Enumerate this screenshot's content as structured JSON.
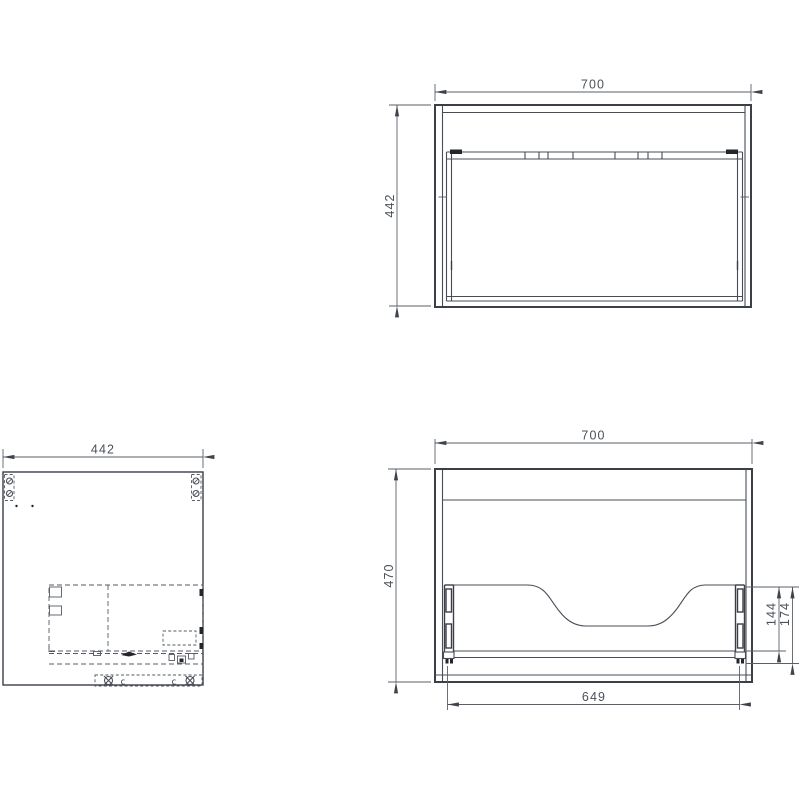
{
  "drawing": {
    "type": "furniture-technical-drawing",
    "views": {
      "plan": {
        "width_label": "700",
        "depth_label": "442"
      },
      "side": {
        "depth_label": "442",
        "runner_letter_left": "c",
        "runner_letter_right": "c"
      },
      "front": {
        "width_label": "700",
        "height_label": "470",
        "drawer_width_label": "649",
        "cutout_height_label": "144",
        "back_panel_height_label": "174"
      }
    },
    "colors": {
      "background": "#ffffff",
      "outline": "#3a3f48",
      "thin_line": "#474d56",
      "dimension_line": "#596069",
      "dimension_text": "#4b515b"
    }
  }
}
